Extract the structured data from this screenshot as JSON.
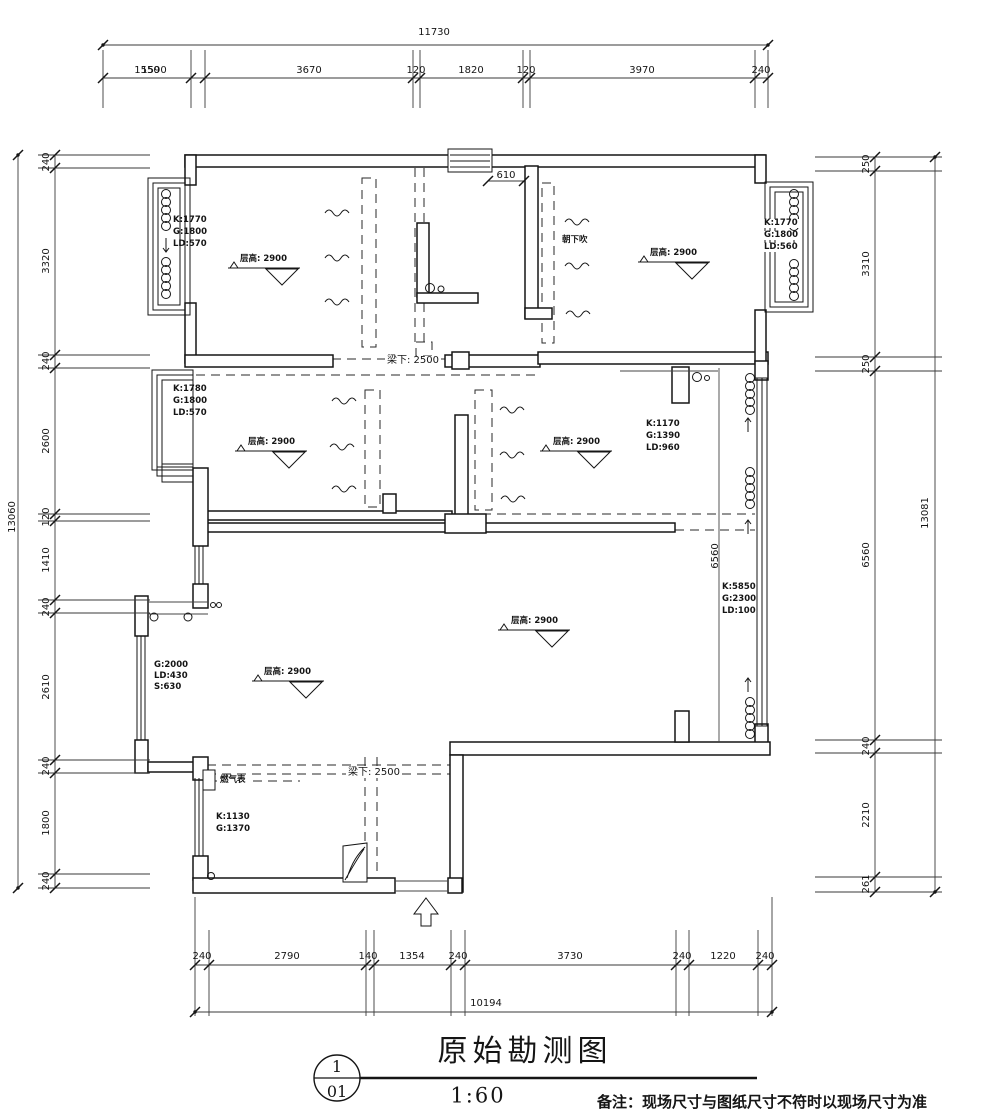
{
  "title_block": {
    "index": "1",
    "sheet": "01",
    "title": "原始勘测图",
    "scale": "1:60",
    "note": "备注：现场尺寸与图纸尺寸不符时以现场尺寸为准"
  },
  "dims": {
    "top": {
      "overall": "11730",
      "labels": [
        "1550",
        "1590",
        "3670",
        "120",
        "1820",
        "120",
        "3970",
        "240"
      ]
    },
    "left": {
      "overall": "13060",
      "labels": [
        "240",
        "3320",
        "240",
        "2600",
        "120",
        "1410",
        "240",
        "2610",
        "240",
        "1800",
        "240"
      ]
    },
    "right": {
      "overall": "13081",
      "labels": [
        "250",
        "3310",
        "250",
        "6560",
        "240",
        "2210",
        "261"
      ]
    },
    "bottom": {
      "overall": "10194",
      "labels": [
        "240",
        "2790",
        "140",
        "1354",
        "240",
        "3730",
        "240",
        "1220",
        "240"
      ]
    },
    "interior": {
      "door": "610",
      "inner": "6560",
      "beam_top": "梁下: 2500",
      "beam_bottom": "梁下: 2500"
    }
  },
  "rooms": {
    "top_left": {
      "level": "层高: 2900",
      "k": "K:1770",
      "g": "G:1800",
      "ld": "LD:570"
    },
    "top_right": {
      "level": "层高: 2900",
      "k": "K:1770",
      "g": "G:1800",
      "ld": "LD:560",
      "note": "朝下吹"
    },
    "mid_left": {
      "level": "层高: 2900",
      "k": "K:1780",
      "g": "G:1800",
      "ld": "LD:570"
    },
    "mid_right": {
      "level": "层高: 2900",
      "k": "K:1170",
      "g": "G:1390",
      "ld": "LD:960"
    },
    "living": {
      "level": "层高: 2900",
      "k": "K:5850",
      "g": "G:2300",
      "ld": "LD:100"
    },
    "lower_left": {
      "level": "层高: 2900",
      "g": "G:2000",
      "ld": "LD:430",
      "s": "S:630"
    },
    "kitchen": {
      "label": "燃气表",
      "k": "K:1130",
      "g": "G:1370"
    }
  }
}
